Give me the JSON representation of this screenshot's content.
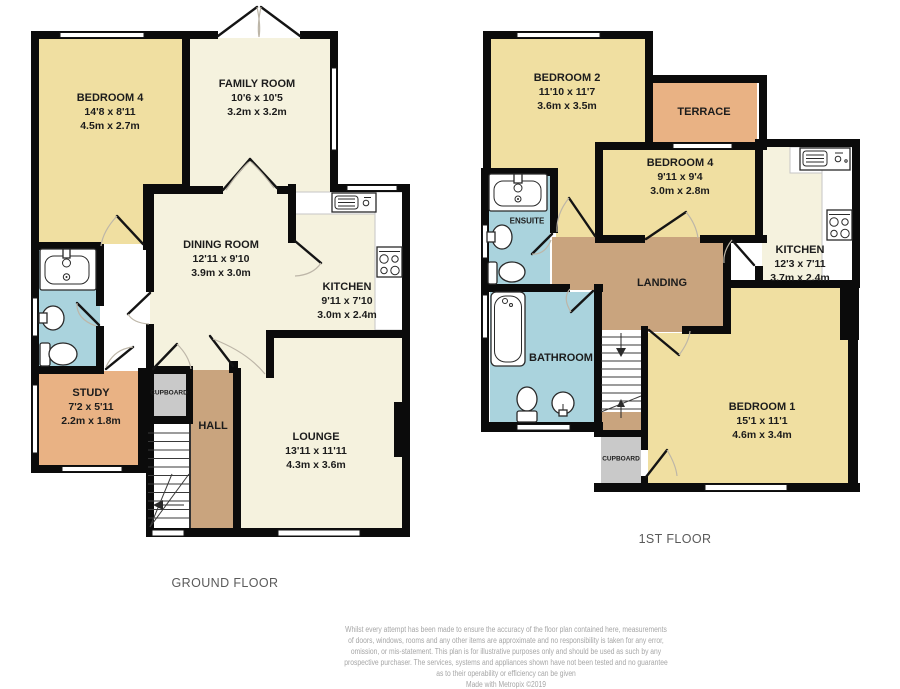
{
  "colors": {
    "room-yellow": "#F0DFA1",
    "room-cream": "#F5F2DE",
    "room-orange": "#E9B284",
    "room-tan": "#C9A47E",
    "room-blue": "#AAD3DD",
    "room-gray": "#C9C9C9",
    "wall": "#0B0B0B",
    "label": "#1C1C1C",
    "title": "#5A5A5A",
    "footer": "#A6A6A6"
  },
  "ground_floor": {
    "title": "GROUND FLOOR",
    "rooms": {
      "bedroom4": {
        "name": "BEDROOM 4",
        "imperial": "14'8 x 8'11",
        "metric": "4.5m x 2.7m"
      },
      "family_room": {
        "name": "FAMILY ROOM",
        "imperial": "10'6 x 10'5",
        "metric": "3.2m x 3.2m"
      },
      "dining_room": {
        "name": "DINING ROOM",
        "imperial": "12'11 x 9'10",
        "metric": "3.9m x 3.0m"
      },
      "kitchen": {
        "name": "KITCHEN",
        "imperial": "9'11 x 7'10",
        "metric": "3.0m x 2.4m"
      },
      "study": {
        "name": "STUDY",
        "imperial": "7'2 x 5'11",
        "metric": "2.2m x 1.8m"
      },
      "lounge": {
        "name": "LOUNGE",
        "imperial": "13'11 x 11'11",
        "metric": "4.3m x 3.6m"
      },
      "hall": {
        "name": "HALL"
      },
      "cupboard": {
        "name": "CUPBOARD"
      }
    }
  },
  "first_floor": {
    "title": "1ST FLOOR",
    "rooms": {
      "bedroom2": {
        "name": "BEDROOM 2",
        "imperial": "11'10 x 11'7",
        "metric": "3.6m x 3.5m"
      },
      "terrace": {
        "name": "TERRACE"
      },
      "bedroom4": {
        "name": "BEDROOM 4",
        "imperial": "9'11 x 9'4",
        "metric": "3.0m x 2.8m"
      },
      "kitchen": {
        "name": "KITCHEN",
        "imperial": "12'3 x 7'11",
        "metric": "3.7m x 2.4m"
      },
      "ensuite": {
        "name": "ENSUITE"
      },
      "bathroom": {
        "name": "BATHROOM"
      },
      "landing": {
        "name": "LANDING"
      },
      "bedroom1": {
        "name": "BEDROOM 1",
        "imperial": "15'1 x 11'1",
        "metric": "4.6m x 3.4m"
      },
      "cupboard": {
        "name": "CUPBOARD"
      }
    }
  },
  "footer": {
    "disclaimer_lines": [
      "Whilst every attempt has been made to ensure the accuracy of the floor plan contained here, measurements",
      "of doors, windows, rooms and any other items are approximate and no responsibility is taken for any error,",
      "omission, or mis-statement. This plan is for illustrative purposes only and should be used as such by any",
      "prospective purchaser. The services, systems and appliances shown have not been tested and no guarantee",
      "as to their operability or efficiency can be given"
    ],
    "credit": "Made with Metropix ©2019"
  }
}
